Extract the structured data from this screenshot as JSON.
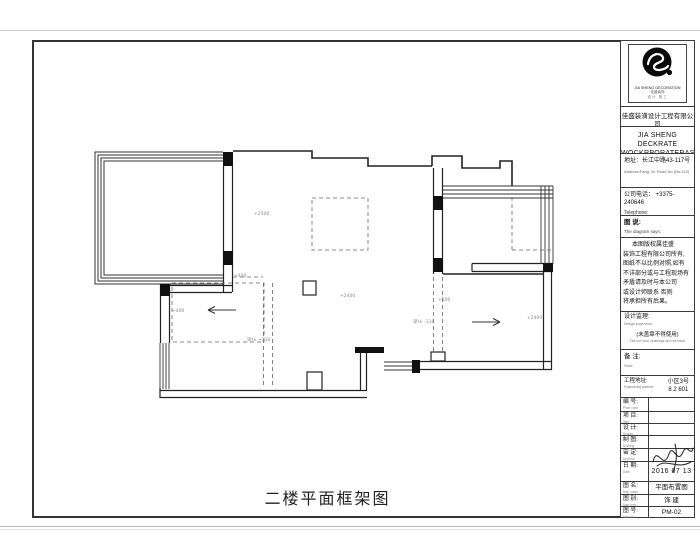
{
  "drawing_title": "二楼平面框架图",
  "colors": {
    "line": "#222222",
    "dashed": "#666666",
    "annotation": "#888888",
    "paper": "#ffffff"
  },
  "titleblock": {
    "logo": {
      "line1": "JIA SHENG DECORATION",
      "line2": "佳盛装饰",
      "line3": "设计·施工"
    },
    "company_zh": "佳盛装潢设计工程有限公司",
    "company_en1": "JIA SHENG DECKRATE",
    "company_en2": "WOCKRPORATERAS",
    "address_zh": "地址：长江中路43-117号",
    "address_en": "Address:Fang, W. Road No.(No:113)",
    "phone_zh": "公司电话： +3375-240646",
    "phone_en": "Telephone:",
    "diagram_says_zh": "图 说:",
    "diagram_says_en": "The diagram says:",
    "notes": [
      "本图版权属佳盛",
      "装饰工程有限公司所有,",
      "图纸不以比例对照,如有",
      "不详部分或与工程现场有",
      "矛盾请及时与本公司",
      "或设计师联系 否则",
      "将承担所有后果。"
    ],
    "supervisor_zh": "设计监理:",
    "supervisor_en": "Design supervisor:",
    "stamp_zh": "(未盖章不得使用)",
    "stamp_en": "Did not seal, drawings are not used",
    "remark_zh": "备 注:",
    "remark_en": "Note:",
    "project_address_zh": "工程地址:",
    "project_address_en": "Engineering address:",
    "project_address_line1": "小区3号",
    "project_address_line2": "8 2 601",
    "rows": [
      {
        "zh": "编 号:",
        "en": "Plate code:",
        "value": ""
      },
      {
        "zh": "项 目:",
        "en": "Item:",
        "value": ""
      },
      {
        "zh": "设 计:",
        "en": "Design:",
        "value": ""
      },
      {
        "zh": "制 图:",
        "en": "Drafting:",
        "value": ""
      },
      {
        "zh": "审 定:",
        "en": "Approve:",
        "value": ""
      },
      {
        "zh": "日 期:",
        "en": "Date:",
        "value": "2016 07 13"
      },
      {
        "zh": "图 名:",
        "en": "Map name:",
        "value": "平面布置图"
      },
      {
        "zh": "图 别:",
        "en": "Map type:",
        "value": "饰 建"
      },
      {
        "zh": "图 号:",
        "en": "Map No.:",
        "value": "PM-02"
      }
    ]
  },
  "plan": {
    "annotations": [
      {
        "text": "+2500",
        "x": 254,
        "y": 215
      },
      {
        "text": "+2400",
        "x": 340,
        "y": 297
      },
      {
        "text": "+2400",
        "x": 527,
        "y": 319
      },
      {
        "text": "+400",
        "x": 234,
        "y": 277
      },
      {
        "text": "+400",
        "x": 172,
        "y": 312
      },
      {
        "text": "梁H₁ +230",
        "x": 247,
        "y": 341
      },
      {
        "text": "梁H₁ -110",
        "x": 413,
        "y": 323
      },
      {
        "text": "+100",
        "x": 438,
        "y": 301
      }
    ]
  }
}
